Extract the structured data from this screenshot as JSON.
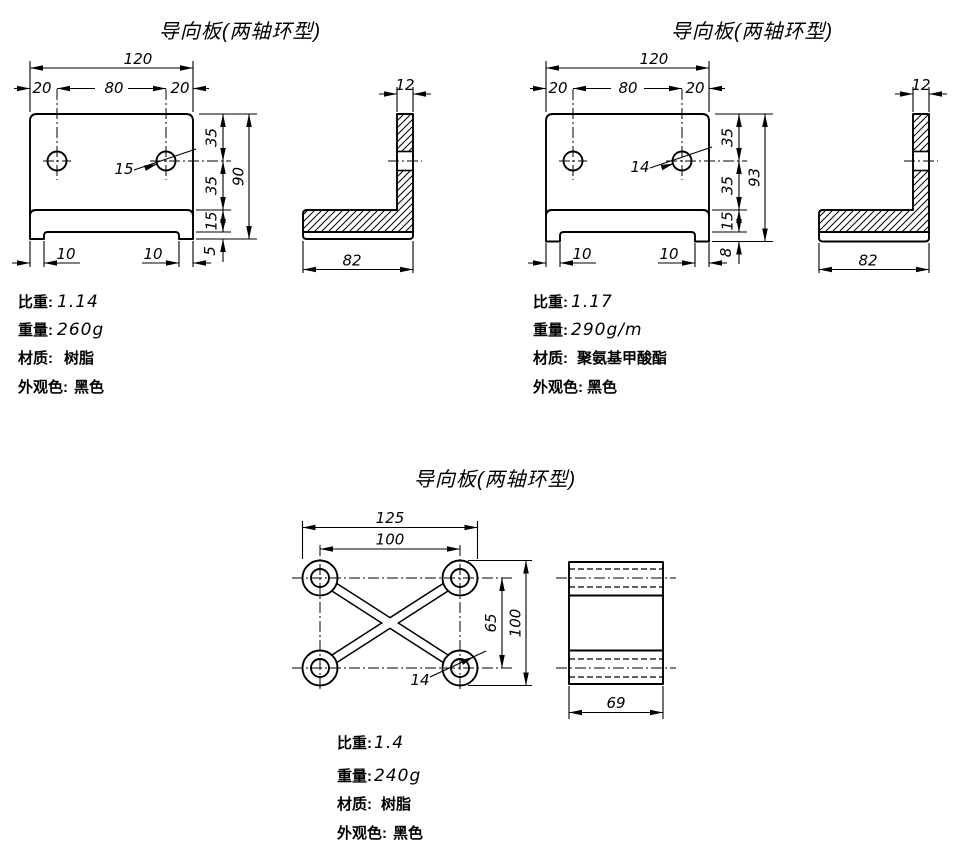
{
  "background": "#ffffff",
  "line_color": "#000000",
  "drawings": [
    {
      "title": "导向板(两轴环型)",
      "front": {
        "width": "120",
        "seg_left": "20",
        "seg_mid": "80",
        "seg_right": "20",
        "h_top": "35",
        "h_mid": "35",
        "h_rail": "15",
        "h_foot": "5",
        "height": "90",
        "hole_dia": "15",
        "foot_left": "10",
        "foot_right": "10"
      },
      "side": {
        "thickness": "12",
        "base": "82"
      },
      "specs": [
        {
          "label": "比重:",
          "value": "1.14"
        },
        {
          "label": "重量:",
          "value": "260g"
        },
        {
          "label": "材质:",
          "value": "树脂"
        },
        {
          "label": "外观色:",
          "value": "黑色"
        }
      ]
    },
    {
      "title": "导向板(两轴环型)",
      "front": {
        "width": "120",
        "seg_left": "20",
        "seg_mid": "80",
        "seg_right": "20",
        "h_top": "35",
        "h_mid": "35",
        "h_rail": "15",
        "h_foot": "8",
        "height": "93",
        "hole_dia": "14",
        "foot_left": "10",
        "foot_right": "10"
      },
      "side": {
        "thickness": "12",
        "base": "82"
      },
      "specs": [
        {
          "label": "比重:",
          "value": "1.17"
        },
        {
          "label": "重量:",
          "value": "290g/m"
        },
        {
          "label": "材质:",
          "value": "聚氨基甲酸酯"
        },
        {
          "label": "外观色:",
          "value": "黑色"
        }
      ]
    },
    {
      "title": "导向板(两轴环型)",
      "front": {
        "width": "125",
        "hole_span": "100",
        "row_span": "65",
        "height": "100",
        "hole_dia": "14"
      },
      "side": {
        "base": "69"
      },
      "specs": [
        {
          "label": "比重:",
          "value": "1.4"
        },
        {
          "label": "重量:",
          "value": "240g"
        },
        {
          "label": "材质:",
          "value": "树脂"
        },
        {
          "label": "外观色:",
          "value": "黑色"
        }
      ]
    }
  ]
}
